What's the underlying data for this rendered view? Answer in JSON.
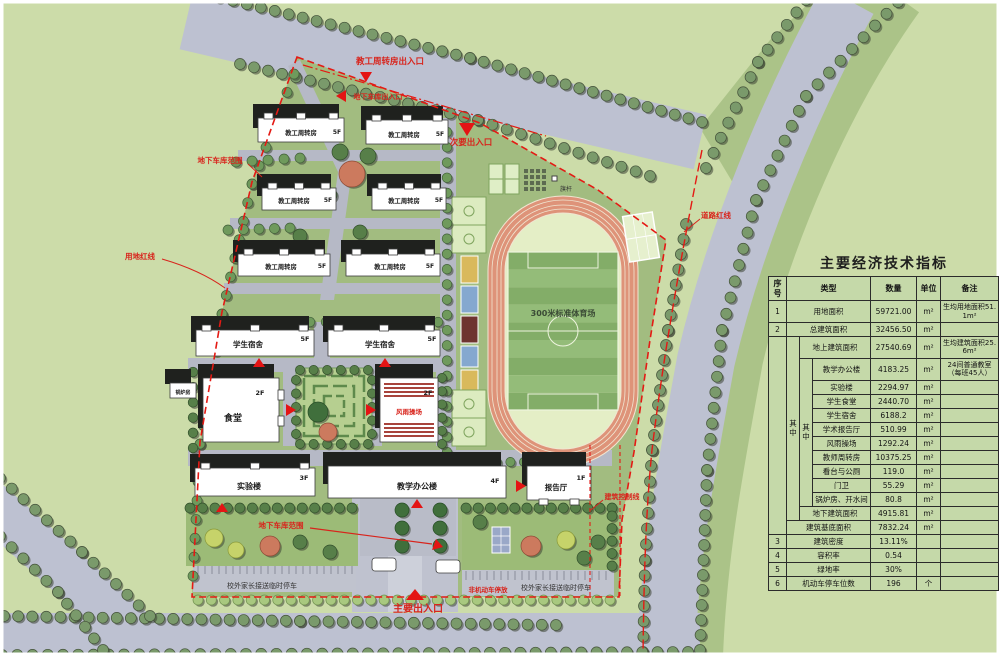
{
  "indicators": {
    "title": "主要经济技术指标",
    "headers": {
      "no": "序号",
      "type": "类型",
      "qty": "数量",
      "unit": "单位",
      "note": "备注"
    },
    "merge_label": "其中",
    "rows": [
      {
        "no": "1",
        "type": "用地面积",
        "qty": "59721.00",
        "unit": "m²",
        "note": "生均用地面积51.1m²"
      },
      {
        "no": "2",
        "type": "总建筑面积",
        "qty": "32456.50",
        "unit": "m²",
        "note": ""
      },
      {
        "type": "地上建筑面积",
        "qty": "27540.69",
        "unit": "m²",
        "note": "生均建筑面积25.6m²"
      },
      {
        "type": "教学办公楼",
        "qty": "4183.25",
        "unit": "m²",
        "note": "24间普通教室（每班45人）"
      },
      {
        "type": "实验楼",
        "qty": "2294.97",
        "unit": "m²",
        "note": ""
      },
      {
        "type": "学生食堂",
        "qty": "2440.70",
        "unit": "m²",
        "note": ""
      },
      {
        "type": "学生宿舍",
        "qty": "6188.2",
        "unit": "m²",
        "note": ""
      },
      {
        "type": "学术报告厅",
        "qty": "510.99",
        "unit": "m²",
        "note": ""
      },
      {
        "type": "风雨操场",
        "qty": "1292.24",
        "unit": "m²",
        "note": ""
      },
      {
        "type": "教师周转房",
        "qty": "10375.25",
        "unit": "m²",
        "note": ""
      },
      {
        "type": "看台与公厕",
        "qty": "119.0",
        "unit": "m²",
        "note": ""
      },
      {
        "type": "门卫",
        "qty": "55.29",
        "unit": "m²",
        "note": ""
      },
      {
        "type": "锅炉房、开水间",
        "qty": "80.8",
        "unit": "m²",
        "note": ""
      },
      {
        "type": "地下建筑面积",
        "qty": "4915.81",
        "unit": "m²",
        "note": ""
      },
      {
        "type": "建筑基底面积",
        "qty": "7832.24",
        "unit": "m²",
        "note": ""
      },
      {
        "no": "3",
        "type": "建筑密度",
        "qty": "13.11%",
        "unit": "",
        "note": ""
      },
      {
        "no": "4",
        "type": "容积率",
        "qty": "0.54",
        "unit": "",
        "note": ""
      },
      {
        "no": "5",
        "type": "绿地率",
        "qty": "30%",
        "unit": "",
        "note": ""
      },
      {
        "no": "6",
        "type": "机动车停车位数",
        "qty": "196",
        "unit": "个",
        "note": ""
      }
    ]
  },
  "plan": {
    "labels": {
      "teacher_housing": "教工周转房",
      "f5": "5F",
      "f4": "4F",
      "f3": "3F",
      "f2": "2F",
      "f1": "1F",
      "dorm": "学生宿舍",
      "canteen": "食堂",
      "lab": "实验楼",
      "teaching": "教学办公楼",
      "hall": "报告厅",
      "boiler": "锅炉房",
      "stadium": "300米标准体育场",
      "flagpole": "旗杆",
      "parking": "校外家长接送临时停车"
    },
    "red_labels": {
      "housing_gate": "教工周转房出入口",
      "garage_gate": "地下车库出入口",
      "secondary_gate": "次要出入口",
      "garage_extent": "地下车库范围",
      "site_line": "用地红线",
      "road_line": "道路红线",
      "control_line": "建筑控制线",
      "main_gate": "主要出入口",
      "bike_parking": "非机动车停放",
      "gym": "风雨操场"
    },
    "colors": {
      "red_line": "#e41a14",
      "road_gray": "#bdc1d1",
      "site_green": "#a2bc80",
      "background_green": "#ccdca9",
      "track_salmon": "#de9379",
      "table_bg": "#c5d9a9"
    }
  }
}
